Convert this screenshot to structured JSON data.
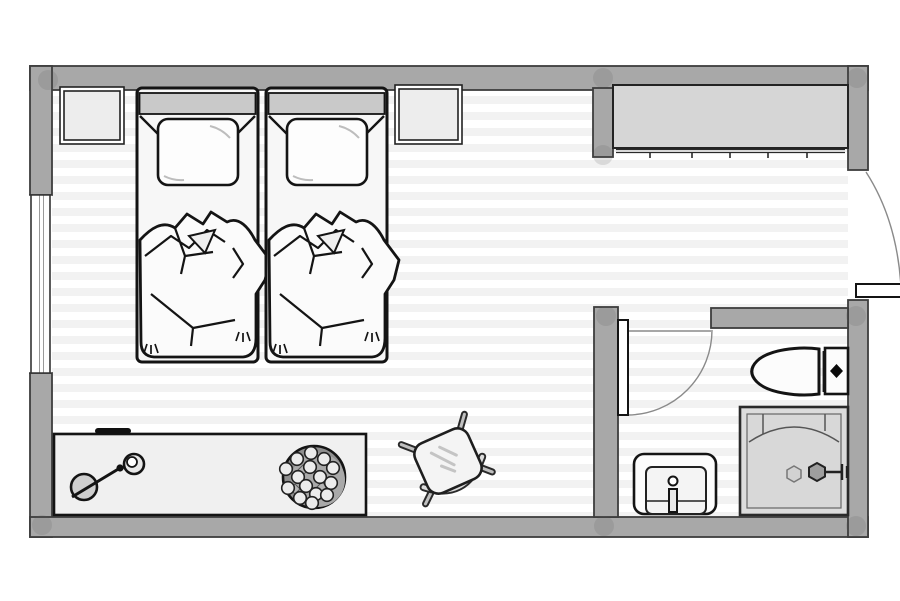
{
  "plan": {
    "type": "floor-plan",
    "view": "top-down",
    "rooms": [
      {
        "name": "bedroom",
        "items": [
          "twin-bed-1",
          "twin-bed-2",
          "nightstand-1",
          "nightstand-2",
          "closet",
          "desk",
          "desk-lamp",
          "pen",
          "fruit-bowl",
          "chair"
        ]
      },
      {
        "name": "bathroom",
        "items": [
          "toilet",
          "shower",
          "sink"
        ]
      }
    ],
    "openings": [
      "window-left",
      "entry-door-right",
      "bathroom-door"
    ],
    "closet_rail_ticks": 5,
    "fruit_count": 15,
    "bed_count": 2,
    "colors": {
      "background": "#ffffff",
      "wall": "#a8a8a8",
      "wall_outline": "#3d3d3d",
      "floor_base": "#ffffff",
      "floor_stripe": "#f2f2f2",
      "closet_fill": "#d6d6d6",
      "furniture_fill": "#f0f0f0",
      "bed_fill": "#f7f7f7",
      "headboard_fill": "#c9c9c9",
      "pillow_fill": "#fdfdfd",
      "shower_fill": "#dcdcdc",
      "shower_inner": "#d8d8d8",
      "bowl_fill": "#a9a9a9",
      "bowl_shadow": "#8f8f8f",
      "fruit_fill": "#ececec",
      "fixture_fill": "#fcfcfc",
      "lamp_base": "#cfcfcf",
      "metal_fill": "#b9b9b9",
      "ink": "#141414",
      "soft_line": "#8a8a8a"
    }
  }
}
